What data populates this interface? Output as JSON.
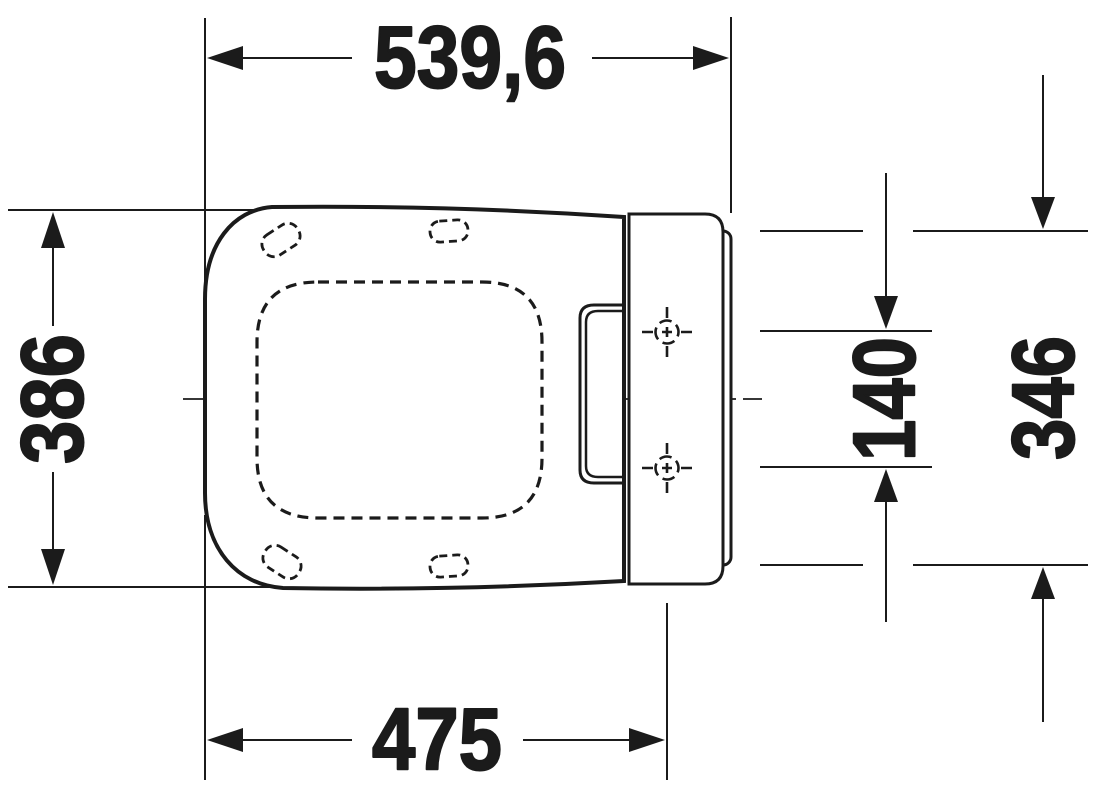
{
  "page": {
    "background": "#ffffff",
    "ink": "#1b1b1b"
  },
  "drawing": {
    "kind": "technical dimension drawing",
    "view": "top view of a toilet seat and cover with hinge mounting plate",
    "units": "mm",
    "labels": {
      "overall_length": "539,6",
      "seat_depth": "386",
      "front_to_hinge_holes": "475",
      "hinge_hole_spacing": "140",
      "mounting_plate_width": "346"
    }
  }
}
